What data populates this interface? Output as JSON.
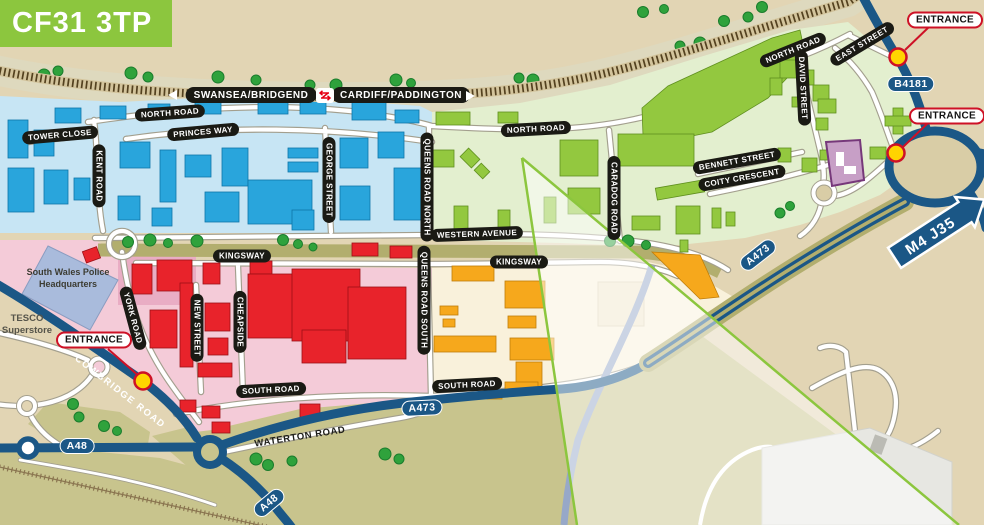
{
  "postcode_badge": {
    "text": "CF31 3TP"
  },
  "railway": {
    "left_destination": "SWANSEA/BRIDGEND",
    "right_destination": "CARDIFF/PADDINGTON",
    "station_icon": "national-rail-icon"
  },
  "roads": {
    "north_road": "NORTH ROAD",
    "tower_close": "TOWER CLOSE",
    "princes_way": "PRINCES WAY",
    "kent_road": "KENT ROAD",
    "george_street": "GEORGE STREET",
    "queens_road_north": "QUEENS ROAD NORTH",
    "caradog_road": "CARADOG ROAD",
    "east_street": "EAST STREET",
    "david_street": "DAVID STREET",
    "bennett_street": "BENNETT STREET",
    "coity_crescent": "COITY CRESCENT",
    "western_avenue": "WESTERN AVENUE",
    "kingsway": "KINGSWAY",
    "queens_road_south": "QUEENS ROAD SOUTH",
    "york_road": "YORK ROAD",
    "new_street": "NEW STREET",
    "cheapside": "CHEAPSIDE",
    "south_road": "SOUTH ROAD",
    "waterton_road": "WATERTON ROAD",
    "cowbridge_road": "COWBRIDGE ROAD"
  },
  "routes": {
    "b4181": "B4181",
    "a473": "A473",
    "a48": "A48",
    "m4_junction": "M4 J35"
  },
  "markers": {
    "entrance": "ENTRANCE"
  },
  "places": {
    "police_line1": "South Wales Police",
    "police_line2": "Headquarters",
    "tesco_line1": "TESCO",
    "tesco_line2": "Superstore"
  },
  "colors": {
    "accent_green": "#8CC63E",
    "road_blue": "#1B5786",
    "zone_blue": "#C7E5F4",
    "zone_green": "#E3EFCF",
    "zone_pink": "#F4CBD8",
    "zone_cream": "#F9F1DB",
    "building_blue": "#29A5DC",
    "building_green": "#93C83F",
    "building_red": "#E8232B",
    "building_orange": "#F6A81C",
    "building_purple": "#C79FC6",
    "entrance_red": "#CE1126",
    "entrance_yellow": "#FFD400"
  }
}
